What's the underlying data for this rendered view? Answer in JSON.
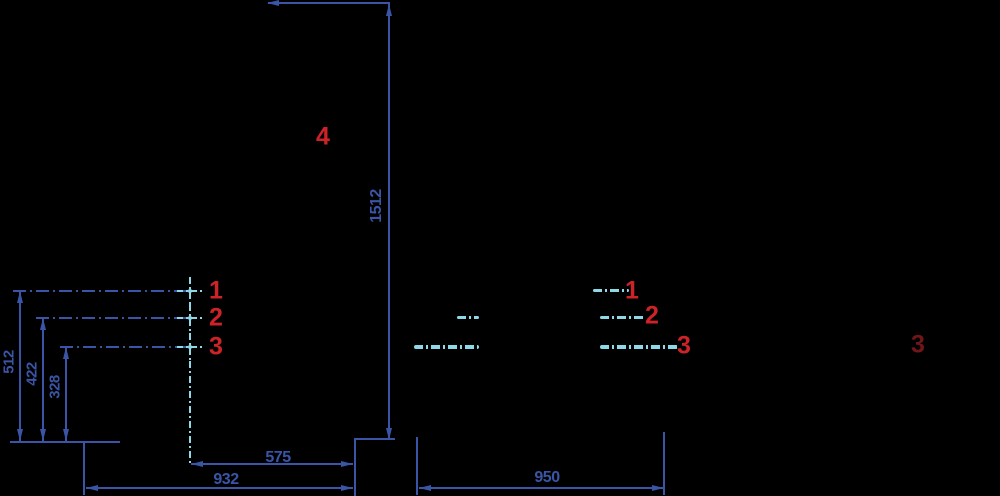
{
  "colors": {
    "background": "#000000",
    "dimension": "#3a55a6",
    "centerline": "#8ed9e8",
    "callout": "#cd2328",
    "callout-faded": "#701618"
  },
  "dimensions": {
    "overall_height": "1512",
    "height_point_1": "512",
    "height_point_2": "422",
    "height_point_3": "328",
    "offset_point_3": "575",
    "depth_left": "932",
    "depth_right": "950"
  },
  "callouts": {
    "left": [
      "1",
      "2",
      "3"
    ],
    "right": [
      "1",
      "2",
      "3"
    ],
    "far_right": "3",
    "upper": "4"
  }
}
